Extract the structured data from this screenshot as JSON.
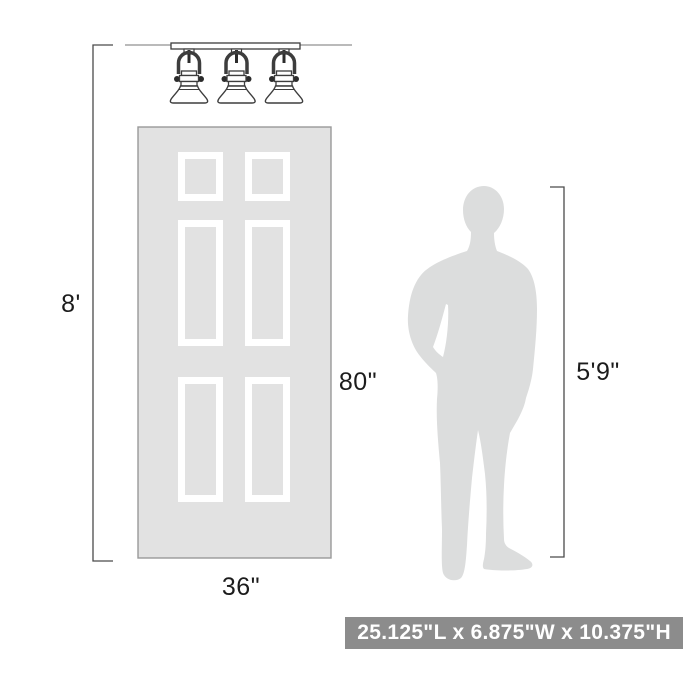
{
  "diagram": {
    "type": "product-dimension-scale-illustration",
    "objects": {
      "fixture": "3-light semi-flush dome ceiling light",
      "fixture_light_count": 3,
      "door": "six-panel door",
      "person": "standing man silhouette"
    },
    "labels": {
      "ceiling_height": "8'",
      "door_height": "80\"",
      "door_width": "36\"",
      "person_height": "5'9\""
    },
    "badge": {
      "text": "25.125\"L x 6.875\"W x 10.375\"H",
      "bg_color": "#8c8c8c",
      "text_color": "#ffffff"
    },
    "colors": {
      "door_fill": "#e2e2e2",
      "door_border": "#999999",
      "silhouette_fill": "#dcdddd",
      "line_color": "#4a4a4a",
      "ceiling_line_color": "#909090"
    }
  }
}
